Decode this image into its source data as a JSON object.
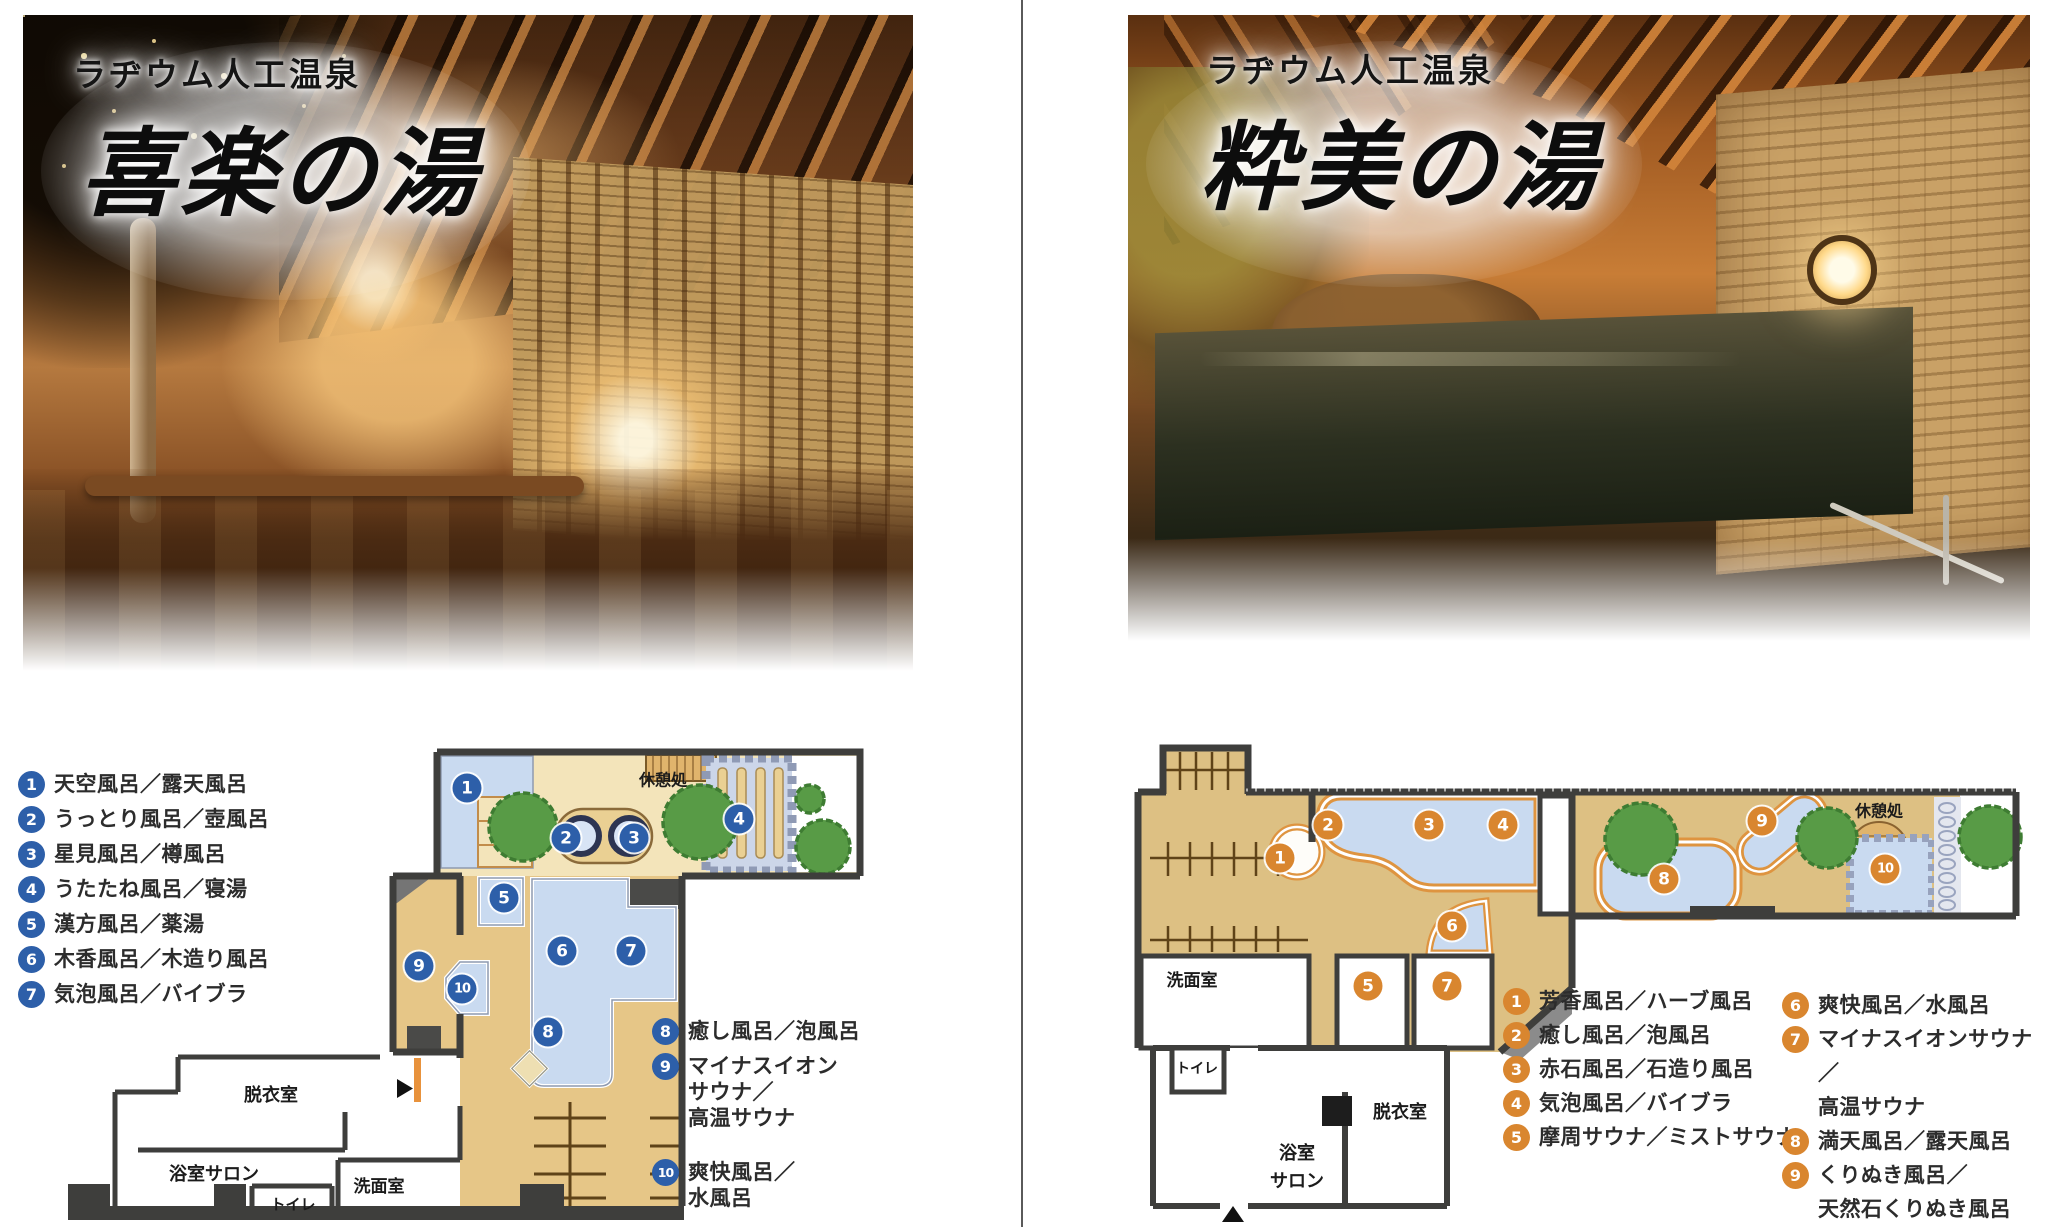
{
  "page": {
    "background": "#ffffff",
    "divider_color": "#5a5a5a"
  },
  "panels": [
    {
      "id": "kiraku",
      "photo": {
        "subtitle": "ラヂウム人工温泉",
        "title": "喜楽の湯"
      },
      "marker_color": "#2d5fa9",
      "legend_columns": [
        {
          "items": [
            {
              "n": "1",
              "lines": [
                "天空風呂／露天風呂"
              ]
            },
            {
              "n": "2",
              "lines": [
                "うっとり風呂／壺風呂"
              ]
            },
            {
              "n": "3",
              "lines": [
                "星見風呂／樽風呂"
              ]
            },
            {
              "n": "4",
              "lines": [
                "うたたね風呂／寝湯"
              ]
            },
            {
              "n": "5",
              "lines": [
                "漢方風呂／薬湯"
              ]
            },
            {
              "n": "6",
              "lines": [
                "木香風呂／木造り風呂"
              ]
            },
            {
              "n": "7",
              "lines": [
                "気泡風呂／バイブラ"
              ]
            }
          ]
        },
        {
          "items": [
            {
              "n": "8",
              "lines": [
                "癒し風呂／泡風呂"
              ]
            },
            {
              "n": "9",
              "lines": [
                "マイナスイオン",
                "サウナ／",
                "高温サウナ"
              ]
            },
            {
              "n": "10",
              "lines": [
                "爽快風呂／",
                "水風呂"
              ]
            }
          ]
        }
      ],
      "plan": {
        "rooms": [
          {
            "label": "休憩処",
            "lines": [
              "休憩処"
            ],
            "x": 663,
            "y": 781,
            "size": 16
          },
          {
            "label": "脱衣室",
            "lines": [
              "脱衣室"
            ],
            "x": 271,
            "y": 1096,
            "size": 18
          },
          {
            "label": "浴室サロン",
            "lines": [
              "浴室サロン"
            ],
            "x": 214,
            "y": 1175,
            "size": 18
          },
          {
            "label": "トイレ",
            "lines": [
              "トイレ"
            ],
            "x": 293,
            "y": 1205,
            "size": 15
          },
          {
            "label": "洗面室",
            "lines": [
              "洗面室"
            ],
            "x": 379,
            "y": 1187,
            "size": 17
          }
        ],
        "markers": [
          {
            "n": "1",
            "x": 467,
            "y": 788
          },
          {
            "n": "2",
            "x": 566,
            "y": 838
          },
          {
            "n": "3",
            "x": 634,
            "y": 838
          },
          {
            "n": "4",
            "x": 739,
            "y": 819
          },
          {
            "n": "5",
            "x": 504,
            "y": 898
          },
          {
            "n": "6",
            "x": 562,
            "y": 951
          },
          {
            "n": "7",
            "x": 631,
            "y": 951
          },
          {
            "n": "8",
            "x": 548,
            "y": 1032
          },
          {
            "n": "9",
            "x": 419,
            "y": 966
          },
          {
            "n": "10",
            "x": 462,
            "y": 989
          }
        ]
      }
    },
    {
      "id": "suibi",
      "photo": {
        "subtitle": "ラヂウム人工温泉",
        "title": "粋美の湯"
      },
      "marker_color": "#d9862f",
      "legend_columns": [
        {
          "items": [
            {
              "n": "1",
              "lines": [
                "芳香風呂／ハーブ風呂"
              ]
            },
            {
              "n": "2",
              "lines": [
                "癒し風呂／泡風呂"
              ]
            },
            {
              "n": "3",
              "lines": [
                "赤石風呂／石造り風呂"
              ]
            },
            {
              "n": "4",
              "lines": [
                "気泡風呂／バイブラ"
              ]
            },
            {
              "n": "5",
              "lines": [
                "摩周サウナ／ミストサウナ"
              ]
            }
          ]
        },
        {
          "items": [
            {
              "n": "6",
              "lines": [
                "爽快風呂／水風呂"
              ]
            },
            {
              "n": "7",
              "lines": [
                "マイナスイオンサウナ／",
                "高温サウナ"
              ]
            },
            {
              "n": "8",
              "lines": [
                "満天風呂／露天風呂"
              ]
            },
            {
              "n": "9",
              "lines": [
                "くりぬき風呂／",
                "天然石くりぬき風呂"
              ]
            },
            {
              "n": "10",
              "lines": [
                "流星滝／滝"
              ]
            }
          ]
        }
      ],
      "plan": {
        "rooms": [
          {
            "label": "休憩処",
            "lines": [
              "休憩処"
            ],
            "x": 1879,
            "y": 812,
            "size": 16
          },
          {
            "label": "洗面室",
            "lines": [
              "洗面室"
            ],
            "x": 1192,
            "y": 981,
            "size": 17
          },
          {
            "label": "トイレ",
            "lines": [
              "トイレ"
            ],
            "x": 1197,
            "y": 1070,
            "size": 14
          },
          {
            "label": "脱衣室",
            "lines": [
              "脱衣室"
            ],
            "x": 1400,
            "y": 1113,
            "size": 18
          },
          {
            "label": "浴室サロン",
            "lines": [
              "浴室",
              "サロン"
            ],
            "x": 1297,
            "y": 1168,
            "size": 18
          }
        ],
        "markers": [
          {
            "n": "1",
            "x": 1280,
            "y": 858
          },
          {
            "n": "2",
            "x": 1328,
            "y": 825
          },
          {
            "n": "3",
            "x": 1429,
            "y": 825
          },
          {
            "n": "4",
            "x": 1503,
            "y": 825
          },
          {
            "n": "5",
            "x": 1368,
            "y": 986
          },
          {
            "n": "6",
            "x": 1452,
            "y": 926
          },
          {
            "n": "7",
            "x": 1447,
            "y": 986
          },
          {
            "n": "8",
            "x": 1664,
            "y": 879
          },
          {
            "n": "9",
            "x": 1762,
            "y": 821
          },
          {
            "n": "10",
            "x": 1885,
            "y": 869
          }
        ]
      }
    }
  ]
}
